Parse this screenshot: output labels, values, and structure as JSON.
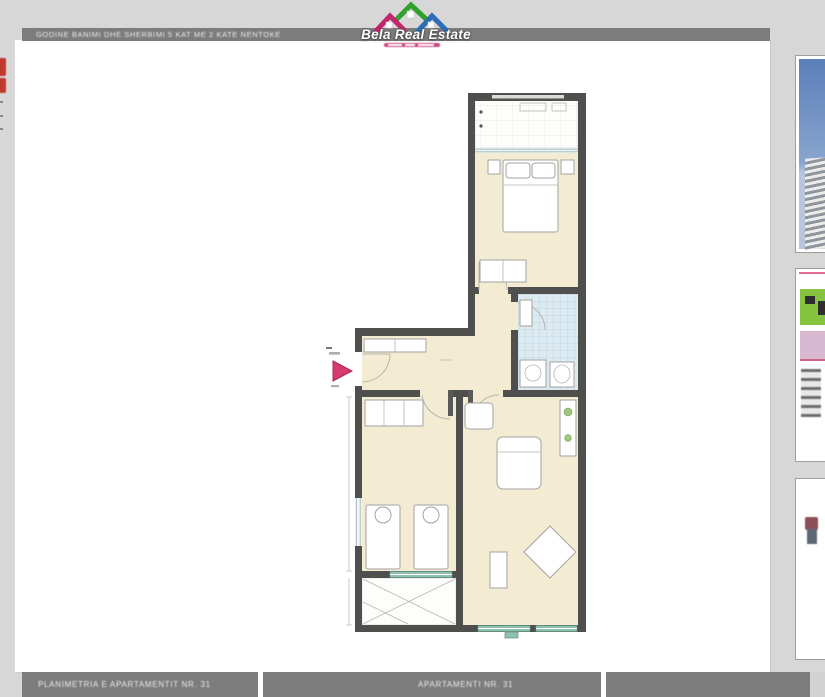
{
  "logo": {
    "brand": "Bela Real Estate"
  },
  "header": {
    "title": "GODINE BANIMI DHE SHERBIMI 5 KAT ME 2 KATE NENTOKE"
  },
  "gallery_footer": {
    "captions": [
      "PLANIMETRIA E APARTAMENTIT NR. 31",
      "APARTAMENTI NR. 31",
      ""
    ]
  },
  "sidebar": {
    "thumbnails": [
      {
        "name": "building-photo-thumbnail"
      },
      {
        "name": "brochure-page-thumbnail"
      },
      {
        "name": "detail-page-thumbnail"
      }
    ]
  },
  "floorplan": {
    "rooms": [
      "terrace-top",
      "bedroom-1",
      "bathroom",
      "hall-corridor",
      "bedroom-2",
      "living-room",
      "terrace-bottom"
    ],
    "entrance_marker": "entrance-arrow"
  },
  "colors": {
    "page_background": "#d7d7d7",
    "panel_background": "#ffffff",
    "bar_background": "#7c7c7c",
    "wall": "#4f4f4d",
    "room_floor": "#f4ecd2",
    "bath_tile": "#dceaf1",
    "window_glass": "#8fbfae",
    "entrance_arrow": "#d63a6e",
    "logo_pink": "#c2256d",
    "logo_green": "#2fa12f",
    "logo_blue": "#2d6db5",
    "sky": "#5b7fba"
  }
}
